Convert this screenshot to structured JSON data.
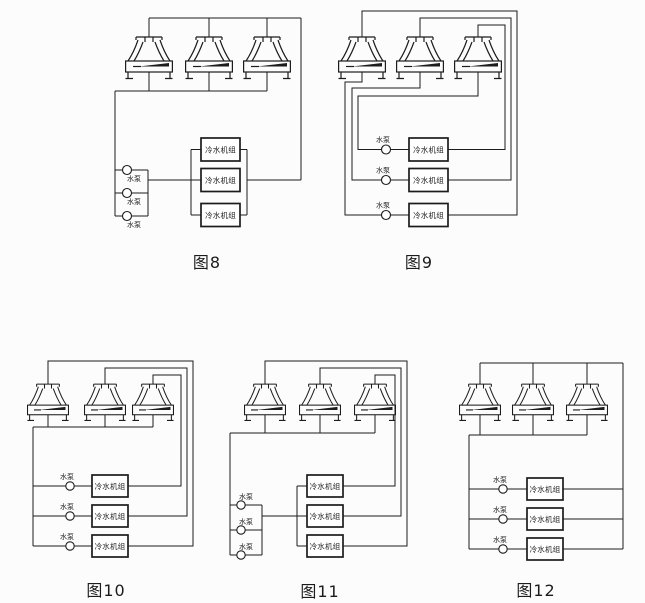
{
  "colors": {
    "background": "#fcfcfc",
    "line": "#1c1c1c"
  },
  "figures": [
    {
      "caption": "图8",
      "cooling_tower_count": 3,
      "chiller_labels": [
        "冷水机组",
        "冷水机组",
        "冷水机组"
      ],
      "pump_labels": [
        "水泵",
        "水泵",
        "水泵"
      ]
    },
    {
      "caption": "图9",
      "cooling_tower_count": 3,
      "chiller_labels": [
        "冷水机组",
        "冷水机组",
        "冷水机组"
      ],
      "pump_labels": [
        "水泵",
        "水泵",
        "水泵"
      ]
    },
    {
      "caption": "图10",
      "cooling_tower_count": 3,
      "chiller_labels": [
        "冷水机组",
        "冷水机组",
        "冷水机组"
      ],
      "pump_labels": [
        "水泵",
        "水泵",
        "水泵"
      ]
    },
    {
      "caption": "图11",
      "cooling_tower_count": 3,
      "chiller_labels": [
        "冷水机组",
        "冷水机组",
        "冷水机组"
      ],
      "pump_labels": [
        "水泵",
        "水泵",
        "水泵"
      ]
    },
    {
      "caption": "图12",
      "cooling_tower_count": 3,
      "chiller_labels": [
        "冷水机组",
        "冷水机组",
        "冷水机组"
      ],
      "pump_labels": [
        "水泵",
        "水泵",
        "水泵"
      ]
    }
  ]
}
